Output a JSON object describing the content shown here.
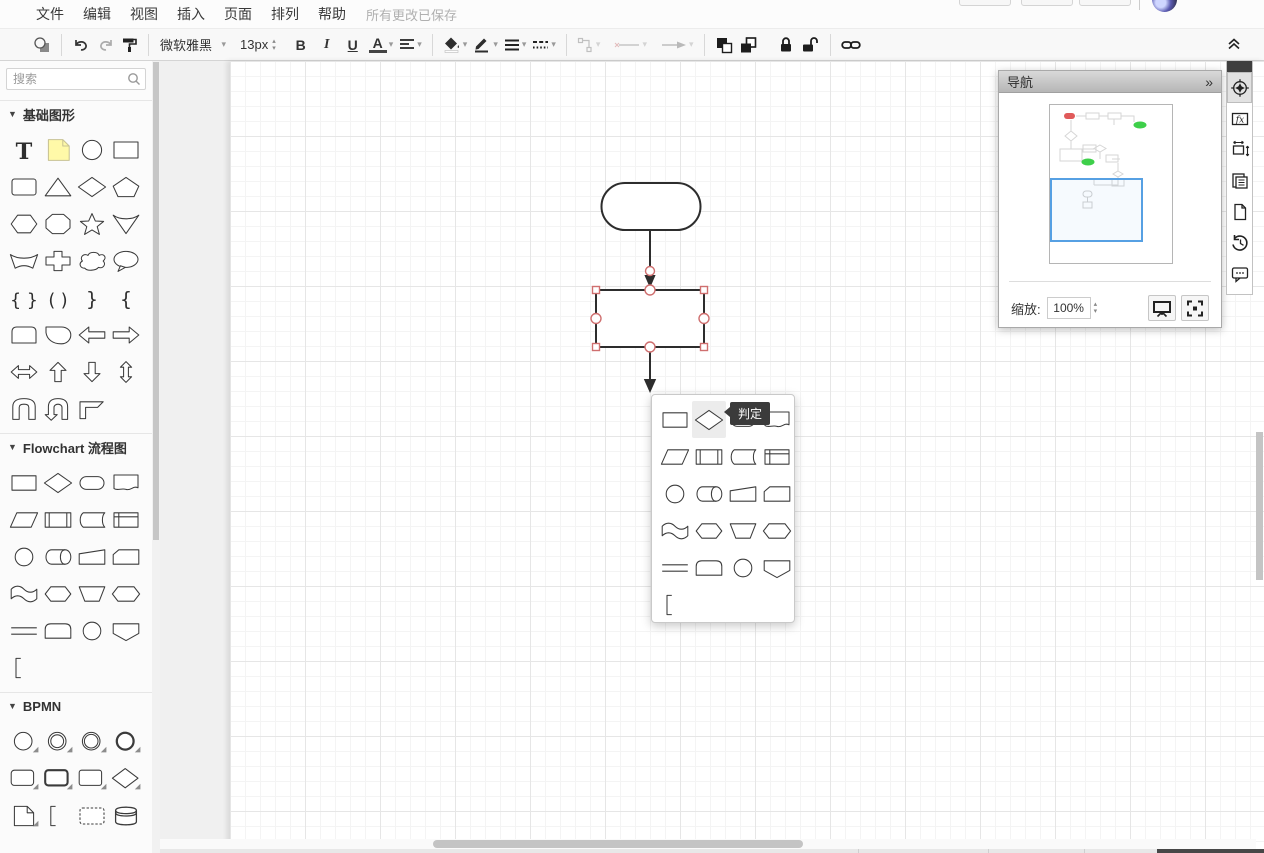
{
  "colors": {
    "handle": "#cf6f6f",
    "accent": "#56a0e3",
    "note": "#fff9a8",
    "mini_red": "#e05a5a",
    "mini_green": "#3ecf4a",
    "tooltip": "#3b3b3b"
  },
  "menubar": {
    "items": [
      "文件",
      "编辑",
      "视图",
      "插入",
      "页面",
      "排列",
      "帮助"
    ],
    "status": "所有更改已保存"
  },
  "toolbar": {
    "font_name": "微软雅黑",
    "font_size": "13px",
    "bold_label": "B",
    "italic_label": "I",
    "underline_label": "U",
    "font_color_label": "A",
    "caret": "▾",
    "collapse_glyph": "chevrons-up",
    "icons": [
      "shape-preview",
      "undo",
      "redo",
      "format-painter",
      "fill-color",
      "line-color",
      "line-style",
      "dash-style",
      "waypoint",
      "connection-line",
      "connection-arrow",
      "to-front",
      "to-back",
      "lock",
      "unlock",
      "link"
    ]
  },
  "sidebar": {
    "search_placeholder": "搜索",
    "sections": [
      {
        "label": "基础图形",
        "shapes": [
          "text",
          "note",
          "ellipse",
          "rectangle",
          "rounded-rectangle",
          "triangle",
          "diamond",
          "pentagon",
          "hexagon",
          "octagon",
          "star",
          "cone",
          "arc-band",
          "cross",
          "cloud",
          "callout",
          "brace-pair",
          "paren-pair",
          "brace-right",
          "brace-left",
          "card-top",
          "blob",
          "arrow-left",
          "arrow-right",
          "arrow-double-h",
          "arrow-up",
          "arrow-down",
          "arrow-double-v",
          "u-loop",
          "u-loop-arrow",
          "corner"
        ]
      },
      {
        "label": "Flowchart 流程图",
        "shapes": [
          "fc-process",
          "fc-decision",
          "fc-terminator",
          "fc-document",
          "fc-data",
          "fc-predefined",
          "fc-stored-data",
          "fc-internal-storage",
          "fc-connector",
          "fc-direct-storage",
          "fc-manual-input",
          "fc-card",
          "fc-tape",
          "fc-hexagon-round",
          "fc-manual-operation",
          "fc-hexagon",
          "fc-divided",
          "fc-display",
          "fc-circle",
          "fc-offpage",
          "fc-bracket"
        ]
      },
      {
        "label": "BPMN",
        "shapes": [
          "bpmn-event",
          "bpmn-event-intermediate",
          "bpmn-event-double",
          "bpmn-event-end",
          "bpmn-task",
          "bpmn-task-thick",
          "bpmn-task-thin",
          "bpmn-gateway",
          "bpmn-document",
          "bpmn-bracket",
          "bpmn-group",
          "bpmn-datastore"
        ]
      }
    ]
  },
  "canvas": {
    "shapes": [
      {
        "type": "terminator",
        "label": "",
        "selected": false
      },
      {
        "type": "rectangle",
        "label": "",
        "selected": true
      }
    ],
    "edge_count": 2
  },
  "popup": {
    "tooltip": "判定",
    "hovered_index": 1,
    "shapes": [
      "fc-process",
      "fc-decision",
      "fc-terminator",
      "fc-document",
      "fc-data",
      "fc-predefined",
      "fc-stored-data",
      "fc-internal-storage",
      "fc-connector",
      "fc-direct-storage",
      "fc-manual-input",
      "fc-card",
      "fc-tape",
      "fc-hexagon-round",
      "fc-manual-operation",
      "fc-hexagon",
      "fc-divided",
      "fc-display",
      "fc-circle",
      "fc-offpage",
      "fc-bracket"
    ]
  },
  "navigation": {
    "title": "导航",
    "collapse_glyph": "»",
    "zoom_label": "缩放:",
    "zoom_value": "100%",
    "buttons": [
      "presentation",
      "fit-page"
    ]
  },
  "right_strip": {
    "icons": [
      "navigation-compass",
      "function-fx",
      "resize-frame",
      "copies",
      "page-outline",
      "history",
      "comments"
    ]
  }
}
